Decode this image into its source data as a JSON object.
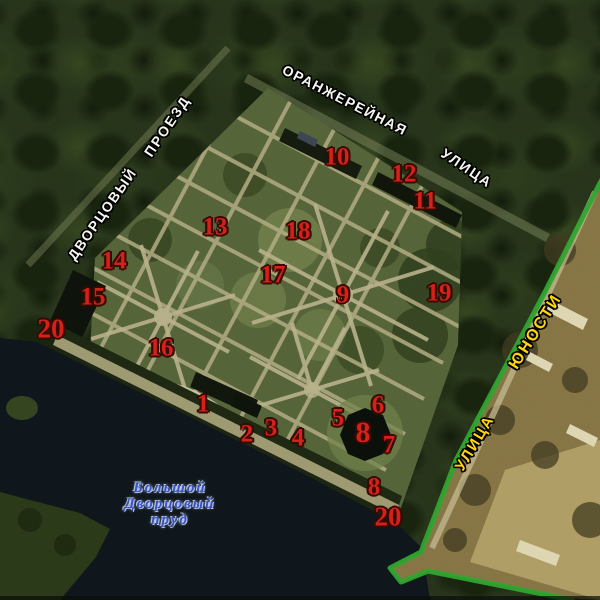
{
  "map": {
    "kind": "satellite-park-scheme",
    "colors": {
      "marker_red": "#d6201a",
      "marker_outline": "#350b02",
      "street_label_white": "#f5f5ef",
      "street_label_yellow": "#ffd60a",
      "boundary_green": "#2ea22e",
      "water_label_blue": "#3a52c4"
    },
    "street_labels": [
      {
        "id": "oranzhereynaya",
        "text": "ОРАНЖЕРЕЙНАЯ",
        "x": 345,
        "y": 100,
        "rotation": 27,
        "color": "white",
        "size": 14,
        "spacing": 1.5
      },
      {
        "id": "ulitsa-top",
        "text": "УЛИЦА",
        "x": 467,
        "y": 168,
        "rotation": 34,
        "color": "white",
        "size": 14,
        "spacing": 2
      },
      {
        "id": "proezd",
        "text": "ПРОЕЗД",
        "x": 167,
        "y": 126,
        "rotation": -56,
        "color": "white",
        "size": 14,
        "spacing": 2
      },
      {
        "id": "dvortsovy",
        "text": "ДВОРЦОВЫЙ",
        "x": 102,
        "y": 214,
        "rotation": -55,
        "color": "white",
        "size": 14,
        "spacing": 1.5
      },
      {
        "id": "yunosti",
        "text": "ЮНОСТИ",
        "x": 536,
        "y": 332,
        "rotation": -58,
        "color": "yellow",
        "size": 16,
        "spacing": 2
      },
      {
        "id": "ulitsa-right",
        "text": "УЛИЦА",
        "x": 475,
        "y": 443,
        "rotation": -59,
        "color": "yellow",
        "size": 15,
        "spacing": 2
      }
    ],
    "water_label": {
      "lines": [
        "Большой",
        "Дворцовый",
        "пруд"
      ],
      "x": 170,
      "y": 504
    },
    "markers": [
      {
        "label": "1",
        "x": 203,
        "y": 404
      },
      {
        "label": "2",
        "x": 247,
        "y": 434
      },
      {
        "label": "3",
        "x": 271,
        "y": 428
      },
      {
        "label": "4",
        "x": 298,
        "y": 438
      },
      {
        "label": "5",
        "x": 338,
        "y": 418
      },
      {
        "label": "6",
        "x": 378,
        "y": 405
      },
      {
        "label": "7",
        "x": 389,
        "y": 445
      },
      {
        "label": "8",
        "x": 363,
        "y": 433,
        "size": 30
      },
      {
        "label": "8",
        "x": 374,
        "y": 487
      },
      {
        "label": "9",
        "x": 343,
        "y": 295
      },
      {
        "label": "10",
        "x": 337,
        "y": 157
      },
      {
        "label": "11",
        "x": 425,
        "y": 201
      },
      {
        "label": "12",
        "x": 404,
        "y": 174
      },
      {
        "label": "13",
        "x": 215,
        "y": 227
      },
      {
        "label": "14",
        "x": 114,
        "y": 261
      },
      {
        "label": "15",
        "x": 93,
        "y": 297
      },
      {
        "label": "16",
        "x": 161,
        "y": 348
      },
      {
        "label": "17",
        "x": 273,
        "y": 275
      },
      {
        "label": "18",
        "x": 298,
        "y": 231
      },
      {
        "label": "19",
        "x": 439,
        "y": 293
      },
      {
        "label": "20",
        "x": 51,
        "y": 329,
        "size": 27
      },
      {
        "label": "20",
        "x": 388,
        "y": 517,
        "size": 27
      }
    ]
  }
}
